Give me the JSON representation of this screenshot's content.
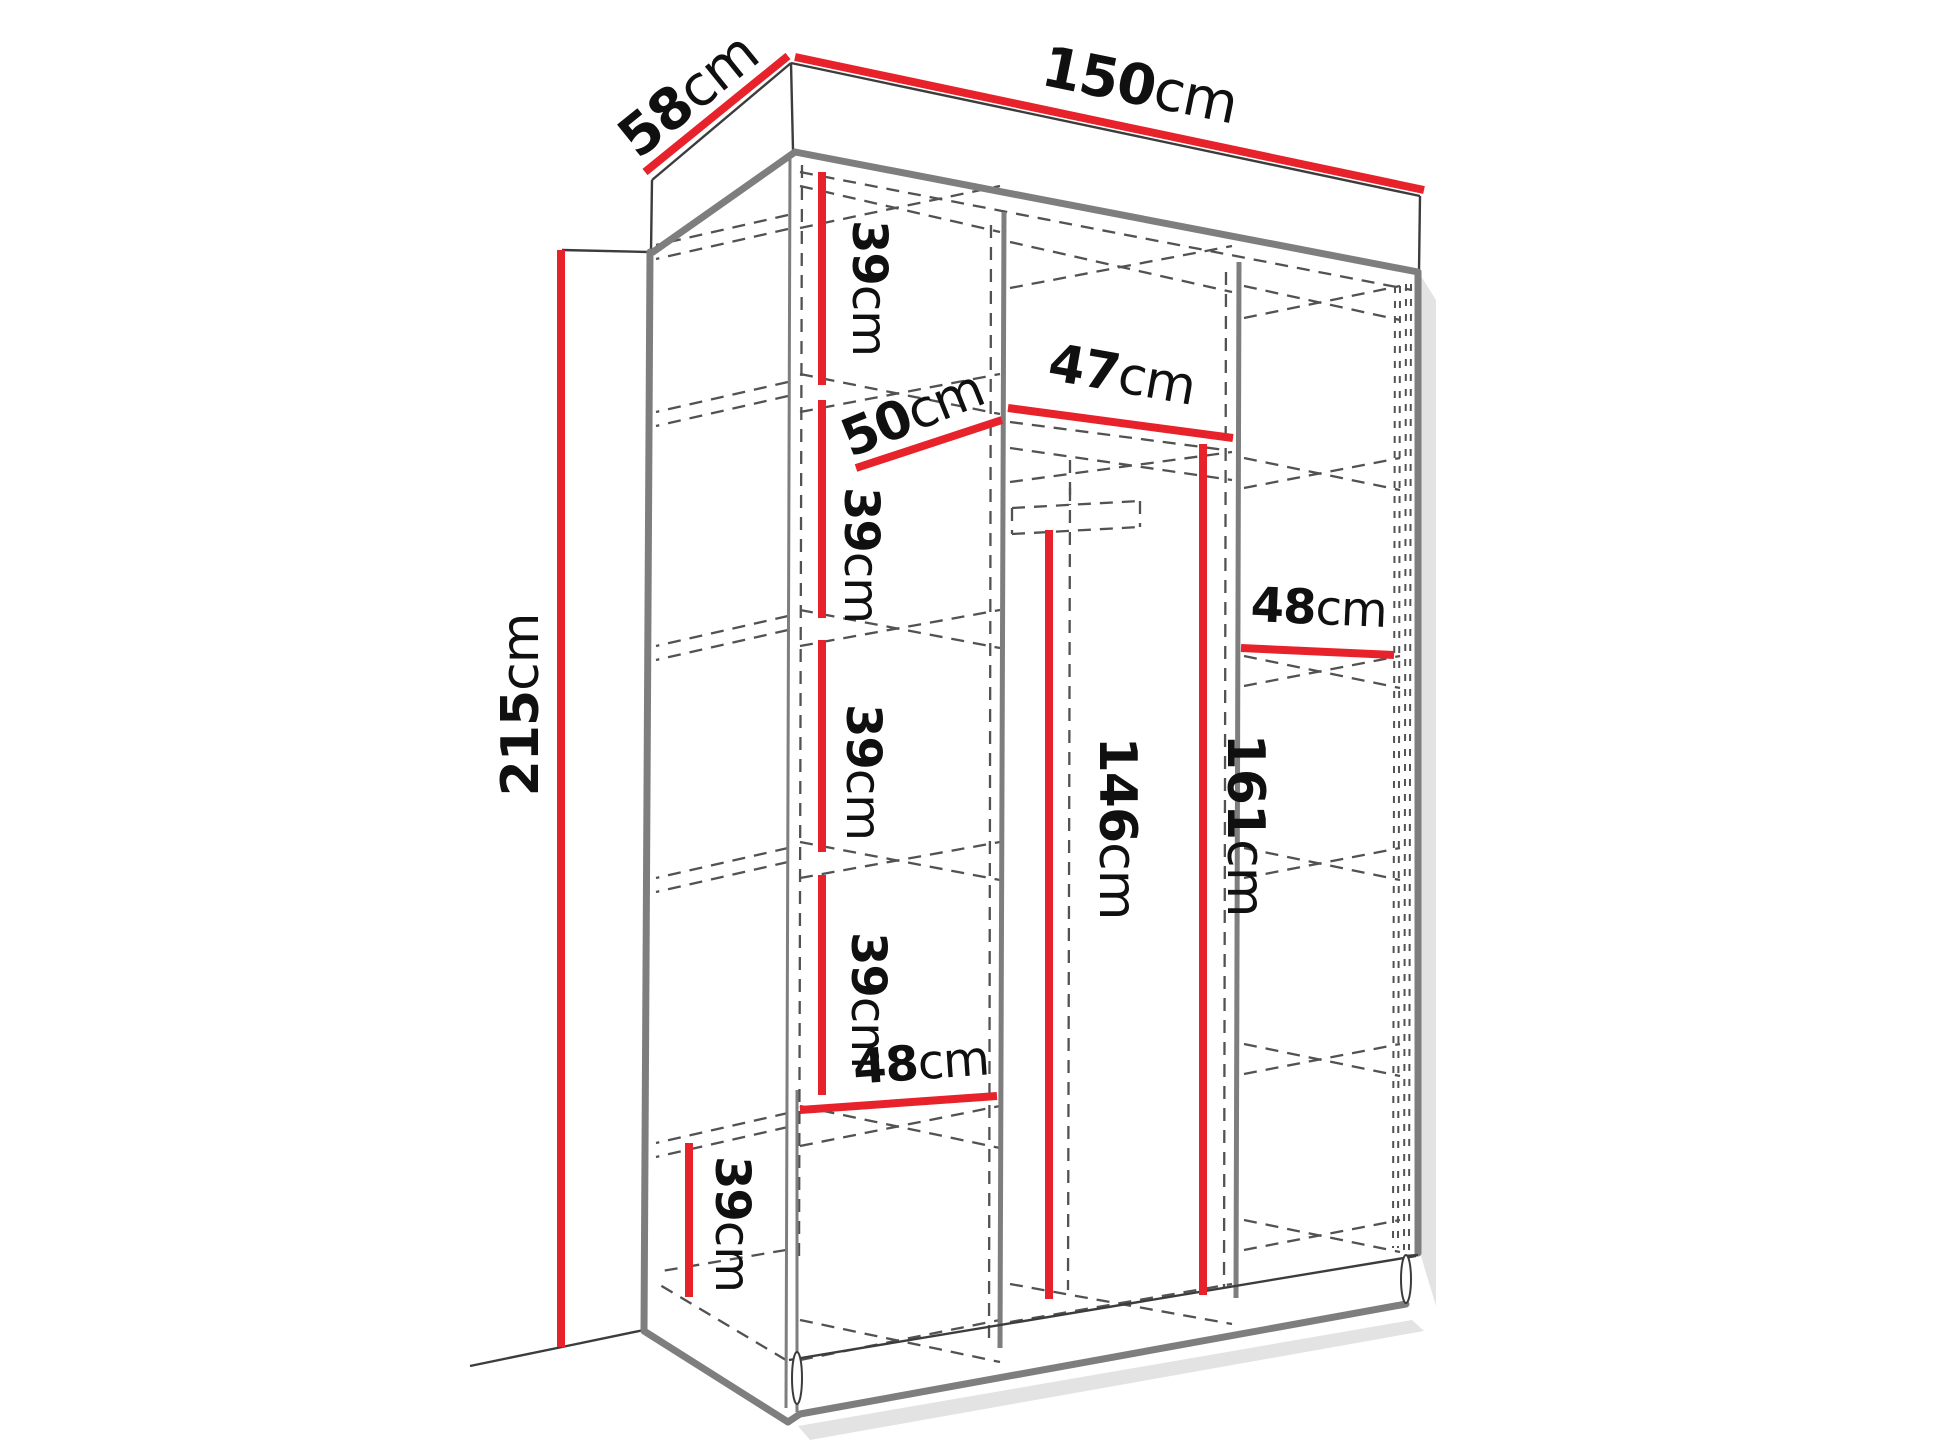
{
  "diagram_type": "wardrobe-dimension-drawing",
  "unit": "cm",
  "colors": {
    "dimension_line": "#e8222b",
    "edge_thick": "#7e7e7e",
    "edge_thin": "#3c3c3c",
    "dash": "#525252",
    "text": "#101010",
    "shadow": "#d9d9d9",
    "background": "#ffffff"
  },
  "labels": [
    {
      "name": "depth",
      "value": "58",
      "unit": "cm"
    },
    {
      "name": "width-total",
      "value": "150",
      "unit": "cm"
    },
    {
      "name": "height-total",
      "value": "215",
      "unit": "cm"
    },
    {
      "name": "left-shelf-gap-1",
      "value": "39",
      "unit": "cm"
    },
    {
      "name": "left-column-width",
      "value": "50",
      "unit": "cm"
    },
    {
      "name": "left-shelf-gap-2",
      "value": "39",
      "unit": "cm"
    },
    {
      "name": "middle-column-width",
      "value": "47",
      "unit": "cm"
    },
    {
      "name": "left-shelf-gap-3",
      "value": "39",
      "unit": "cm"
    },
    {
      "name": "right-column-width",
      "value": "48",
      "unit": "cm"
    },
    {
      "name": "left-shelf-gap-4",
      "value": "39",
      "unit": "cm"
    },
    {
      "name": "hanging-height",
      "value": "146",
      "unit": "cm"
    },
    {
      "name": "middle-inner-height",
      "value": "161",
      "unit": "cm"
    },
    {
      "name": "left-bottom-width",
      "value": "48",
      "unit": "cm"
    },
    {
      "name": "left-bottom-gap",
      "value": "39",
      "unit": "cm"
    }
  ]
}
